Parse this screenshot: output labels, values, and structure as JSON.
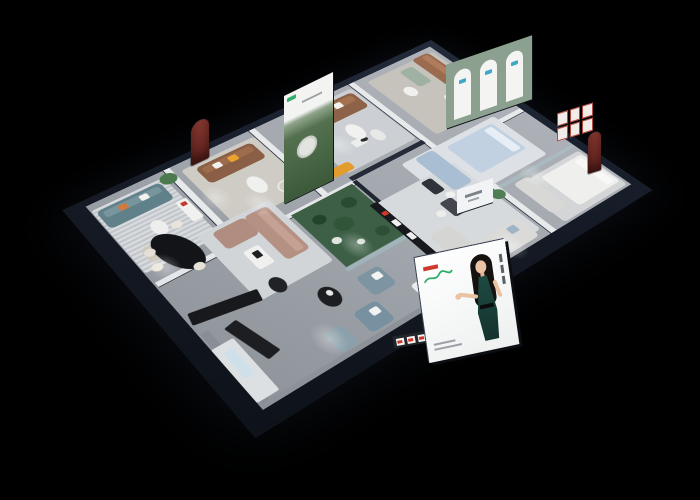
{
  "meta": {
    "scene": "isometric 3d cutaway render of a furniture showroom floor plan on black background",
    "background": "#000000"
  },
  "palette": {
    "outer_wall": "#161c28",
    "floor": "#a2a7ad",
    "partition": "#e7e9eb",
    "atrium_green": "#3c5f45",
    "leather_brown": "#8e6249",
    "teal_sofa": "#60808a",
    "taupe_sofa": "#b59184",
    "accent_orange": "#e09b2d",
    "billboard_red": "#cf382b",
    "billboard_green": "#2fae6b",
    "dress_teal": "#1d4a42"
  },
  "billboard": {
    "background": "#f5f5f4",
    "logo_mark_color": "#cf382b",
    "logo_script_color": "#2fae6b",
    "model": {
      "hair": "#14110f",
      "skin": "#eac2a4",
      "dress": "#1d4a42"
    },
    "vertical_text_blocks": 3,
    "caption_lines": 2
  },
  "plan": {
    "w": 355,
    "h": 470,
    "wall": "#161c28",
    "floor": "#a2a7ad"
  },
  "items": [
    {
      "n": "wall-suite-divider",
      "x": 10,
      "y": 122,
      "w": 160,
      "h": 7,
      "c": "#e7e9eb",
      "s": "0 1px 0 #2a3140"
    },
    {
      "n": "wall-mid-divider",
      "x": 10,
      "y": 254,
      "w": 140,
      "h": 7,
      "c": "#e7e9eb",
      "s": "0 1px 0 #2a3140"
    },
    {
      "n": "wall-poster-divider",
      "x": 10,
      "y": 357,
      "w": 140,
      "h": 7,
      "c": "#e7e9eb",
      "s": "0 1px 0 #2a3140"
    },
    {
      "n": "wall-spine",
      "x": 148,
      "y": 222,
      "w": 7,
      "h": 226,
      "c": "#e3e5e8",
      "s": "1px 0 0 #2a3140"
    },
    {
      "n": "wall-center-left",
      "x": 168,
      "y": 10,
      "w": 7,
      "h": 114,
      "c": "#e7e9eb",
      "s": "1px 0 0 #2a3140"
    },
    {
      "n": "wall-right-divider",
      "x": 178,
      "y": 115,
      "w": 157,
      "h": 7,
      "c": "#e7e9eb",
      "s": "0 1px 0 #2a3140"
    },
    {
      "n": "wall-media-dark",
      "x": 142,
      "y": 128,
      "w": 7,
      "h": 96,
      "c": "#262c37"
    },
    {
      "n": "wall-dining",
      "x": 60,
      "y": 377,
      "w": 90,
      "h": 7,
      "c": "#e7e9eb",
      "s": "0 1px 0 #2a3140"
    },
    {
      "n": "wall-atrium-frame",
      "x": 150,
      "y": 220,
      "w": 100,
      "h": 5,
      "c": "#20262f"
    },
    {
      "n": "glass-atrium-right",
      "x": 246,
      "y": 225,
      "w": 5,
      "h": 78,
      "c": "#9fc3c8",
      "o": 0.55
    },
    {
      "n": "glass-center-partition",
      "x": 250,
      "y": 12,
      "w": 5,
      "h": 104,
      "c": "#a8c6cb",
      "o": 0.5
    },
    {
      "n": "wall-bottom-inner-face",
      "x": 230,
      "y": 440,
      "w": 103,
      "h": 8,
      "c": "#888e95"
    },
    {
      "n": "wall-right-inner-face",
      "x": 329,
      "y": 215,
      "w": 6,
      "h": 232,
      "c": "#8d9298"
    },
    {
      "n": "rug-arch-suite",
      "x": 20,
      "y": 15,
      "w": 125,
      "h": 95,
      "c": "#c6c3bd",
      "r": "4px"
    },
    {
      "n": "rug-center-suite",
      "x": 160,
      "y": 42,
      "w": 85,
      "h": 128,
      "c": "#dde1e5",
      "r": "4px"
    },
    {
      "n": "rug-right-far",
      "x": 262,
      "y": 13,
      "w": 70,
      "h": 88,
      "c": "#d3d5d6",
      "r": "4px"
    },
    {
      "n": "rug-mid-lounge",
      "x": 18,
      "y": 131,
      "w": 118,
      "h": 90,
      "c": "#ccd0d4",
      "r": "4px"
    },
    {
      "n": "rug-right-band",
      "x": 192,
      "y": 126,
      "w": 132,
      "h": 104,
      "c": "#d7dadc",
      "r": "4px"
    },
    {
      "n": "rug-poster-room",
      "x": 22,
      "y": 262,
      "w": 108,
      "h": 88,
      "c": "#cfccc5",
      "r": "4px"
    },
    {
      "n": "rug-teal-room",
      "x": 20,
      "y": 369,
      "w": 112,
      "h": 80,
      "c": "#d9dcdf",
      "st": 1,
      "r": "3px"
    },
    {
      "n": "rug-taupe-lounge",
      "x": 118,
      "y": 305,
      "w": 112,
      "h": 82,
      "c": "#d2d5d8",
      "r": "4px"
    },
    {
      "n": "atrium-floor",
      "x": 152,
      "y": 227,
      "w": 93,
      "h": 74,
      "c": "#3c5f45"
    },
    {
      "n": "atrium-cactus",
      "x": 165,
      "y": 238,
      "w": 16,
      "h": 16,
      "c": "#2a4a31",
      "r": "50%"
    },
    {
      "n": "atrium-cactus",
      "x": 185,
      "y": 258,
      "w": 20,
      "h": 20,
      "c": "#315538",
      "r": "50%"
    },
    {
      "n": "atrium-cactus",
      "x": 168,
      "y": 276,
      "w": 14,
      "h": 14,
      "c": "#24432c",
      "r": "50%"
    },
    {
      "n": "atrium-cactus",
      "x": 220,
      "y": 238,
      "w": 14,
      "h": 14,
      "c": "#2d4f35",
      "r": "50%"
    },
    {
      "n": "atrium-flower",
      "x": 205,
      "y": 282,
      "w": 10,
      "h": 10,
      "c": "#dfe6df",
      "r": "50%"
    },
    {
      "n": "atrium-flower",
      "x": 222,
      "y": 266,
      "w": 8,
      "h": 8,
      "c": "#d6dfd6",
      "r": "50%"
    },
    {
      "n": "sofa-brown-arch-suite",
      "x": 18,
      "y": 20,
      "w": 66,
      "h": 24,
      "c": "#9a6b4f",
      "r": "5px"
    },
    {
      "n": "sofa-cushion",
      "x": 21,
      "y": 23,
      "w": 60,
      "h": 9,
      "c": "#b07c5b",
      "r": "3px"
    },
    {
      "n": "armchair-white",
      "x": 96,
      "y": 38,
      "w": 26,
      "h": 24,
      "c": "#ededec",
      "r": "5px"
    },
    {
      "n": "loveseat-sage",
      "x": 28,
      "y": 52,
      "w": 38,
      "h": 18,
      "c": "#9fb1a3",
      "r": "4px"
    },
    {
      "n": "table-round-small",
      "x": 56,
      "y": 76,
      "w": 20,
      "h": 14,
      "c": "#f0f0ef",
      "r": "50%"
    },
    {
      "n": "plant",
      "x": 128,
      "y": 13,
      "w": 16,
      "h": 16,
      "c": "#4d7a50",
      "r": "50%"
    },
    {
      "n": "bed-blue",
      "x": 168,
      "y": 52,
      "w": 56,
      "h": 64,
      "c": "#c2d1e1",
      "r": "4px"
    },
    {
      "n": "bed-pillow",
      "x": 172,
      "y": 56,
      "w": 48,
      "h": 11,
      "c": "#e8eef5",
      "r": "3px"
    },
    {
      "n": "sofa-powder-blue",
      "x": 162,
      "y": 130,
      "w": 66,
      "h": 24,
      "c": "#a9bed3",
      "r": "5px"
    },
    {
      "n": "table-dark",
      "x": 196,
      "y": 160,
      "w": 24,
      "h": 13,
      "c": "#2f343b",
      "r": "3px"
    },
    {
      "n": "bed-white",
      "x": 268,
      "y": 15,
      "w": 56,
      "h": 58,
      "c": "#efefee",
      "r": "4px"
    },
    {
      "n": "bed-pillow",
      "x": 272,
      "y": 19,
      "w": 48,
      "h": 10,
      "c": "#f8f8f7",
      "r": "3px"
    },
    {
      "n": "sofa-gray-far",
      "x": 258,
      "y": 82,
      "w": 58,
      "h": 20,
      "c": "#d8d8d7",
      "r": "5px"
    },
    {
      "n": "sofa-leather-brown",
      "x": 24,
      "y": 135,
      "w": 34,
      "h": 73,
      "c": "#8e6249",
      "r": "6px"
    },
    {
      "n": "sofa-cushion",
      "x": 28,
      "y": 139,
      "w": 12,
      "h": 64,
      "c": "#a4724f",
      "r": "4px"
    },
    {
      "n": "pillow-orange",
      "x": 30,
      "y": 174,
      "w": 10,
      "h": 10,
      "c": "#e8952f",
      "r": "2px"
    },
    {
      "n": "pillow-white",
      "x": 30,
      "y": 156,
      "w": 10,
      "h": 10,
      "c": "#f2f2f0",
      "r": "2px"
    },
    {
      "n": "statue-pedestal",
      "x": 96,
      "y": 174,
      "w": 12,
      "h": 15,
      "c": "#eceded",
      "r": "2px"
    },
    {
      "n": "statue",
      "x": 99,
      "y": 170,
      "w": 6,
      "h": 9,
      "c": "#2b2b2e",
      "r": "50%"
    },
    {
      "n": "bench-orange",
      "x": 58,
      "y": 211,
      "w": 38,
      "h": 12,
      "c": "#e09b2d",
      "r": "3px"
    },
    {
      "n": "chaise-orange",
      "x": 120,
      "y": 209,
      "w": 14,
      "h": 27,
      "c": "#e39d2f",
      "r": "4px"
    },
    {
      "n": "table-oval-white",
      "x": 70,
      "y": 165,
      "w": 30,
      "h": 17,
      "c": "#f1f1f0",
      "r": "50%"
    },
    {
      "n": "table-oval-white",
      "x": 94,
      "y": 152,
      "w": 22,
      "h": 13,
      "c": "#e8e8e6",
      "r": "50%"
    },
    {
      "n": "sofa-gray-l",
      "x": 298,
      "y": 133,
      "w": 32,
      "h": 78,
      "c": "#dadad9",
      "r": "5px"
    },
    {
      "n": "sofa-gray-chaise",
      "x": 262,
      "y": 190,
      "w": 38,
      "h": 26,
      "c": "#d5d5d4",
      "r": "5px"
    },
    {
      "n": "pillow-blue",
      "x": 302,
      "y": 142,
      "w": 10,
      "h": 10,
      "c": "#9fb4c6",
      "r": "2px"
    },
    {
      "n": "dining-table-small",
      "x": 232,
      "y": 163,
      "w": 26,
      "h": 15,
      "c": "#43474d",
      "r": "3px"
    },
    {
      "n": "chair-white",
      "x": 224,
      "y": 156,
      "w": 10,
      "h": 10,
      "c": "#f0f0ee",
      "r": "50%"
    },
    {
      "n": "chair-white",
      "x": 240,
      "y": 181,
      "w": 10,
      "h": 10,
      "c": "#ededeb",
      "r": "50%"
    },
    {
      "n": "media-shelf-black",
      "x": 190,
      "y": 224,
      "w": 112,
      "h": 9,
      "c": "#17191d",
      "r": "1px"
    },
    {
      "n": "media-accent-red",
      "x": 206,
      "y": 225,
      "w": 6,
      "h": 6,
      "c": "#d03a2c",
      "r": "1px"
    },
    {
      "n": "media-card",
      "x": 222,
      "y": 225,
      "w": 10,
      "h": 6,
      "c": "#f2f2f2",
      "r": "1px"
    },
    {
      "n": "media-card",
      "x": 246,
      "y": 225,
      "w": 10,
      "h": 6,
      "c": "#efefef",
      "r": "1px"
    },
    {
      "n": "bed-white-low",
      "x": 302,
      "y": 222,
      "w": 26,
      "h": 48,
      "c": "#ebecec",
      "r": "4px"
    },
    {
      "n": "sofa-taupe-body",
      "x": 124,
      "y": 312,
      "w": 78,
      "h": 26,
      "c": "#b59184",
      "r": "5px"
    },
    {
      "n": "sofa-cushion",
      "x": 128,
      "y": 316,
      "w": 70,
      "h": 9,
      "c": "#c4a193",
      "r": "3px"
    },
    {
      "n": "sofa-taupe-chaise",
      "x": 124,
      "y": 338,
      "w": 30,
      "h": 36,
      "c": "#b08d80",
      "r": "5px"
    },
    {
      "n": "coffee-table-white",
      "x": 166,
      "y": 348,
      "w": 30,
      "h": 17,
      "c": "#f0f0ef",
      "r": "3px"
    },
    {
      "n": "coffee-tray-black",
      "x": 172,
      "y": 352,
      "w": 10,
      "h": 7,
      "c": "#1d1f22",
      "r": "1px"
    },
    {
      "n": "side-table-black",
      "x": 212,
      "y": 355,
      "w": 22,
      "h": 15,
      "c": "#202226",
      "r": "50%"
    },
    {
      "n": "armchair-blue",
      "x": 262,
      "y": 277,
      "w": 30,
      "h": 26,
      "c": "#7d95a3",
      "r": "5px"
    },
    {
      "n": "armchair-blue",
      "x": 296,
      "y": 305,
      "w": 30,
      "h": 26,
      "c": "#7791a0",
      "r": "5px"
    },
    {
      "n": "pillow-white",
      "x": 268,
      "y": 281,
      "w": 9,
      "h": 9,
      "c": "#f4f4f2",
      "r": "2px"
    },
    {
      "n": "pillow-white",
      "x": 302,
      "y": 309,
      "w": 9,
      "h": 9,
      "c": "#f2f2f0",
      "r": "2px"
    },
    {
      "n": "ottoman-blue",
      "x": 300,
      "y": 346,
      "w": 28,
      "h": 19,
      "c": "#8ba0ab",
      "r": "5px"
    },
    {
      "n": "table-black-round",
      "x": 252,
      "y": 325,
      "w": 28,
      "h": 19,
      "c": "#1c1e21",
      "r": "50%"
    },
    {
      "n": "table-decor",
      "x": 258,
      "y": 329,
      "w": 8,
      "h": 6,
      "c": "#e8e8e6",
      "r": "50%"
    },
    {
      "n": "sofa-teal",
      "x": 24,
      "y": 376,
      "w": 32,
      "h": 70,
      "c": "#60808a",
      "r": "6px"
    },
    {
      "n": "sofa-cushion",
      "x": 28,
      "y": 380,
      "w": 11,
      "h": 61,
      "c": "#78959d",
      "r": "3px"
    },
    {
      "n": "pillow-orange",
      "x": 30,
      "y": 417,
      "w": 9,
      "h": 9,
      "c": "#cf7a3e",
      "r": "2px"
    },
    {
      "n": "pillow-white",
      "x": 30,
      "y": 394,
      "w": 9,
      "h": 9,
      "c": "#f1f1ef",
      "r": "2px"
    },
    {
      "n": "plant",
      "x": 16,
      "y": 357,
      "w": 18,
      "h": 18,
      "c": "#4a7a4e",
      "r": "50%"
    },
    {
      "n": "table-round-white",
      "x": 72,
      "y": 401,
      "w": 24,
      "h": 15,
      "c": "#eeeeec",
      "r": "50%"
    },
    {
      "n": "armchair-beige",
      "x": 100,
      "y": 417,
      "w": 24,
      "h": 21,
      "c": "#cec7bb",
      "r": "5px"
    },
    {
      "n": "sofa-brown-poster-room",
      "x": 28,
      "y": 270,
      "w": 32,
      "h": 67,
      "c": "#8a5f46",
      "r": "6px"
    },
    {
      "n": "sofa-cushion",
      "x": 32,
      "y": 274,
      "w": 11,
      "h": 58,
      "c": "#9d6c4c",
      "r": "3px"
    },
    {
      "n": "pillow-yellow",
      "x": 34,
      "y": 293,
      "w": 10,
      "h": 10,
      "c": "#eda22f",
      "r": "2px"
    },
    {
      "n": "pillow-white",
      "x": 34,
      "y": 312,
      "w": 9,
      "h": 9,
      "c": "#f2f2f0",
      "r": "2px"
    },
    {
      "n": "table-oval-white",
      "x": 76,
      "y": 293,
      "w": 30,
      "h": 17,
      "c": "#f0f0ef",
      "r": "50%"
    },
    {
      "n": "floor-lamp-ring",
      "x": 104,
      "y": 271,
      "w": 16,
      "h": 16,
      "c": "transparent",
      "r": "50%",
      "s": "0 0 0 2px #e8e8e6"
    },
    {
      "n": "dining-table-black-oval",
      "x": 92,
      "y": 394,
      "w": 66,
      "h": 34,
      "c": "#121418",
      "r": "50%",
      "ro": -14
    },
    {
      "n": "dining-chair-cream",
      "x": 86,
      "y": 388,
      "w": 11,
      "h": 11,
      "c": "#e9e4da",
      "r": "50%"
    },
    {
      "n": "dining-chair-cream",
      "x": 104,
      "y": 427,
      "w": 11,
      "h": 11,
      "c": "#e5e0d6",
      "r": "50%"
    },
    {
      "n": "dining-chair-cream",
      "x": 126,
      "y": 431,
      "w": 11,
      "h": 11,
      "c": "#eae5db",
      "r": "50%"
    },
    {
      "n": "dining-chair-cream",
      "x": 150,
      "y": 400,
      "w": 11,
      "h": 11,
      "c": "#e7e2d8",
      "r": "50%"
    },
    {
      "n": "shelf-white",
      "x": 62,
      "y": 367,
      "w": 36,
      "h": 12,
      "c": "#f1f1f0",
      "r": "2px"
    },
    {
      "n": "shelf-accent-red",
      "x": 66,
      "y": 370,
      "w": 6,
      "h": 6,
      "c": "#c23a2e",
      "r": "1px"
    },
    {
      "n": "sideboard-black",
      "x": 208,
      "y": 381,
      "w": 16,
      "h": 66,
      "c": "#17191d",
      "r": "2px",
      "ro": 12
    },
    {
      "n": "bench-black",
      "x": 236,
      "y": 409,
      "w": 56,
      "h": 14,
      "c": "#1c1e22",
      "r": "2px",
      "ro": -12
    },
    {
      "n": "galley-counter-white",
      "x": 252,
      "y": 428,
      "w": 74,
      "h": 22,
      "c": "#dde0e3",
      "r": "2px"
    },
    {
      "n": "island-light-blue",
      "x": 262,
      "y": 434,
      "w": 36,
      "h": 10,
      "c": "#cfe0ea",
      "r": "2px"
    },
    {
      "n": "plant",
      "x": 252,
      "y": 116,
      "w": 15,
      "h": 15,
      "c": "#507e53",
      "r": "50%"
    },
    {
      "n": "plant",
      "x": 118,
      "y": 266,
      "w": 13,
      "h": 13,
      "c": "#46724a",
      "r": "50%"
    },
    {
      "n": "spotlight-glow",
      "x": 70,
      "y": 186,
      "w": 44,
      "h": 28,
      "g": 1
    },
    {
      "n": "spotlight-glow",
      "x": 240,
      "y": 62,
      "w": 44,
      "h": 28,
      "g": 1
    },
    {
      "n": "spotlight-glow",
      "x": 95,
      "y": 301,
      "w": 44,
      "h": 28,
      "g": 1
    },
    {
      "n": "spotlight-glow",
      "x": 205,
      "y": 262,
      "w": 44,
      "h": 28,
      "g": 1
    },
    {
      "n": "spotlight-glow",
      "x": 285,
      "y": 350,
      "w": 44,
      "h": 28,
      "g": 1
    },
    {
      "n": "spotlight-glow",
      "x": 115,
      "y": 417,
      "w": 44,
      "h": 28,
      "g": 1
    },
    {
      "n": "spotlight-glow",
      "x": 300,
      "y": 150,
      "w": 44,
      "h": 28,
      "g": 1
    },
    {
      "n": "spotlight-glow",
      "x": 60,
      "y": 330,
      "w": 44,
      "h": 28,
      "g": 1
    }
  ]
}
